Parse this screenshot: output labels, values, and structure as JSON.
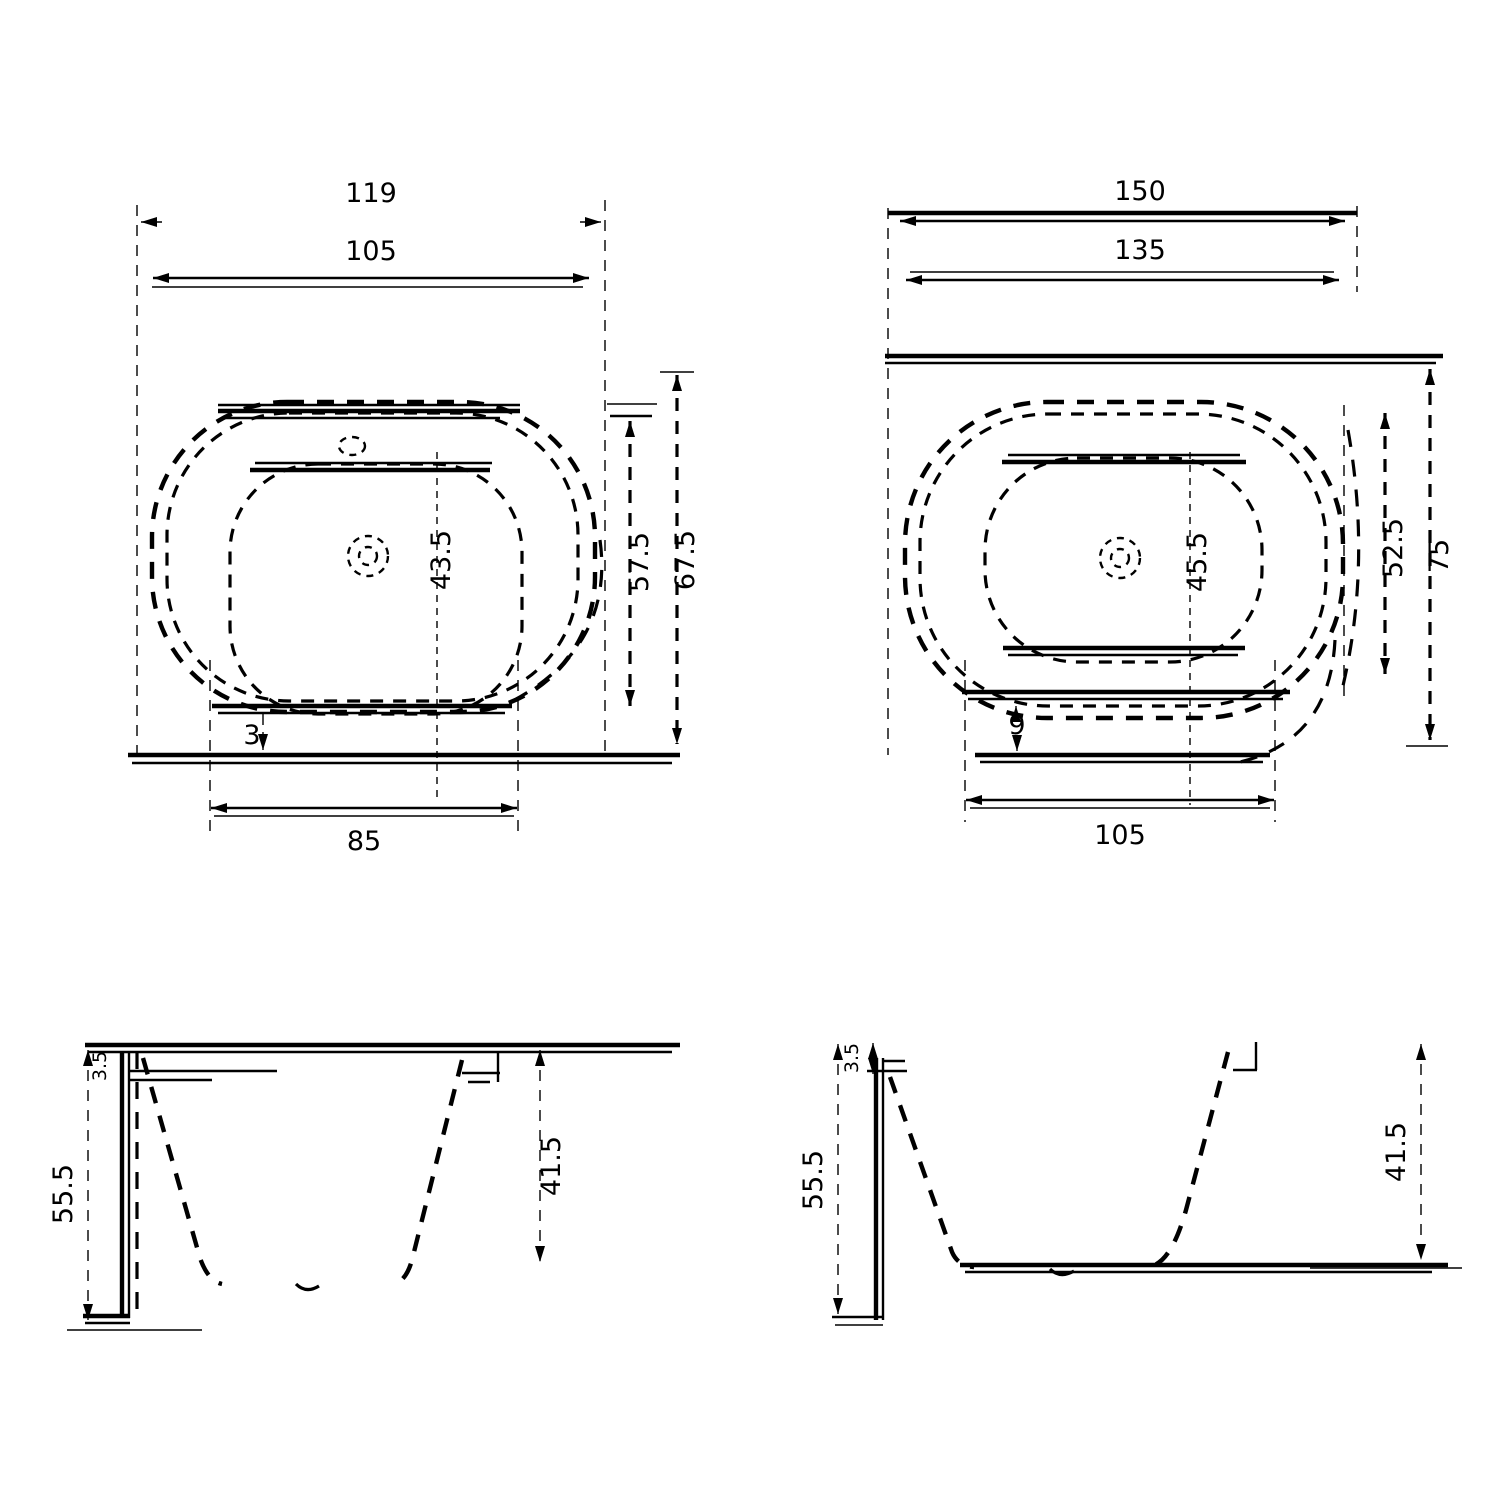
{
  "colors": {
    "background": "#ffffff",
    "line": "#000000"
  },
  "views": {
    "plan_left": {
      "dims": {
        "outer_width": "119",
        "rim_width": "105",
        "bottom_width": "85",
        "center_offset": "43.5",
        "edge_gap": "3",
        "depth_inner": "57.5",
        "depth_outer": "67.5"
      }
    },
    "plan_right": {
      "dims": {
        "outer_width": "150",
        "rim_width": "135",
        "bottom_width": "105",
        "center_offset": "45.5",
        "edge_gap": "9",
        "depth_inner": "52.5",
        "depth_outer": "75"
      }
    },
    "elev_left": {
      "dims": {
        "total_height": "55.5",
        "rim_thickness": "3.5",
        "inner_depth": "41.5"
      }
    },
    "elev_right": {
      "dims": {
        "total_height": "55.5",
        "rim_thickness": "3.5",
        "inner_depth": "41.5"
      }
    }
  }
}
